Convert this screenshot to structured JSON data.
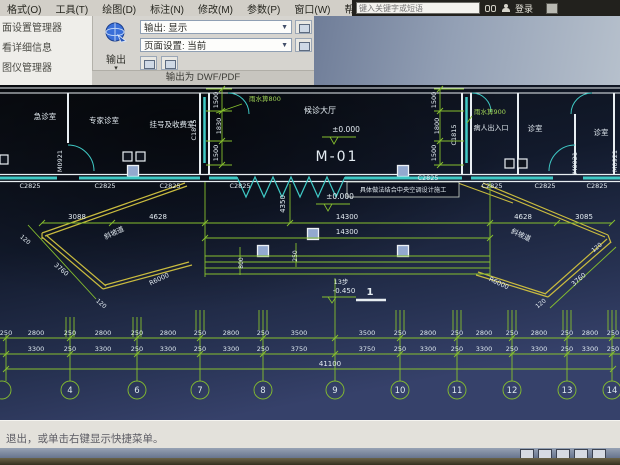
{
  "titlebar": {
    "search_placeholder": "键入关键字或短语",
    "sign_in_label": "登录"
  },
  "menu": {
    "items": [
      "格式(O)",
      "工具(T)",
      "绘图(D)",
      "标注(N)",
      "修改(M)",
      "参数(P)",
      "窗口(W)",
      "帮助(H)"
    ]
  },
  "palette": {
    "items": [
      "面设置管理器",
      "看详细信息",
      "图仪管理器"
    ]
  },
  "ribbon": {
    "output_button_label": "输出",
    "output_combo_value": "输出: 显示",
    "page_setup_combo_value": "页面设置: 当前",
    "panel_title": "输出为 DWF/PDF"
  },
  "drawing": {
    "colors": {
      "dim_green": "#86bf2e",
      "window_cyan": "#3fc9c5",
      "canopy_yellow": "#c9bb3f",
      "wall_white": "#e8eef2"
    },
    "room_labels": {
      "r1": "急诊室",
      "r2": "专家诊室",
      "r3": "挂号及收费室",
      "hall": "候诊大厅",
      "r4": "诊室",
      "r5": "诊室"
    },
    "door_main": "M-01",
    "door_side": "M0921",
    "win_c2825": "C2825",
    "win_c1815": "C1815",
    "note": "具体做法结合中央空调设计施工",
    "rain800": "雨水箅800",
    "rain900": "雨水箅900",
    "entrance": "病人出入口",
    "ramp": "斜坡道",
    "r6000": "R6000",
    "d3760": "3760",
    "d120": "120",
    "elev_zero": "±0.000",
    "elev_neg": "-0.450",
    "steps13": "13步",
    "section1": "1",
    "d3088": "3088",
    "d4628": "4628",
    "d14300": "14300",
    "d3085": "3085",
    "d4350": "4350",
    "d41100": "41100",
    "d800": "800",
    "d250": "250",
    "side_dims_left": [
      "1500",
      "1830",
      "1500"
    ],
    "side_dims_right": [
      "1500",
      "1800",
      "1500"
    ],
    "chain_row1": [
      "250",
      "2800",
      "250",
      "2800",
      "250",
      "2800",
      "250",
      "2800",
      "250",
      "3500",
      "3500",
      "250",
      "2800",
      "250",
      "2800",
      "250",
      "2800",
      "250",
      "2800",
      "250"
    ],
    "chain_row2": [
      "3300",
      "250",
      "3300",
      "250",
      "3300",
      "250",
      "3300",
      "250",
      "3750",
      "3750",
      "250",
      "3300",
      "250",
      "3300",
      "250",
      "3300",
      "250",
      "3300",
      "250"
    ],
    "grid_bubbles": [
      "4",
      "6",
      "7",
      "8",
      "9",
      "10",
      "11",
      "12",
      "13",
      "14"
    ]
  },
  "statusbar": {
    "command_text": "退出，或单击右键显示快捷菜单。"
  }
}
